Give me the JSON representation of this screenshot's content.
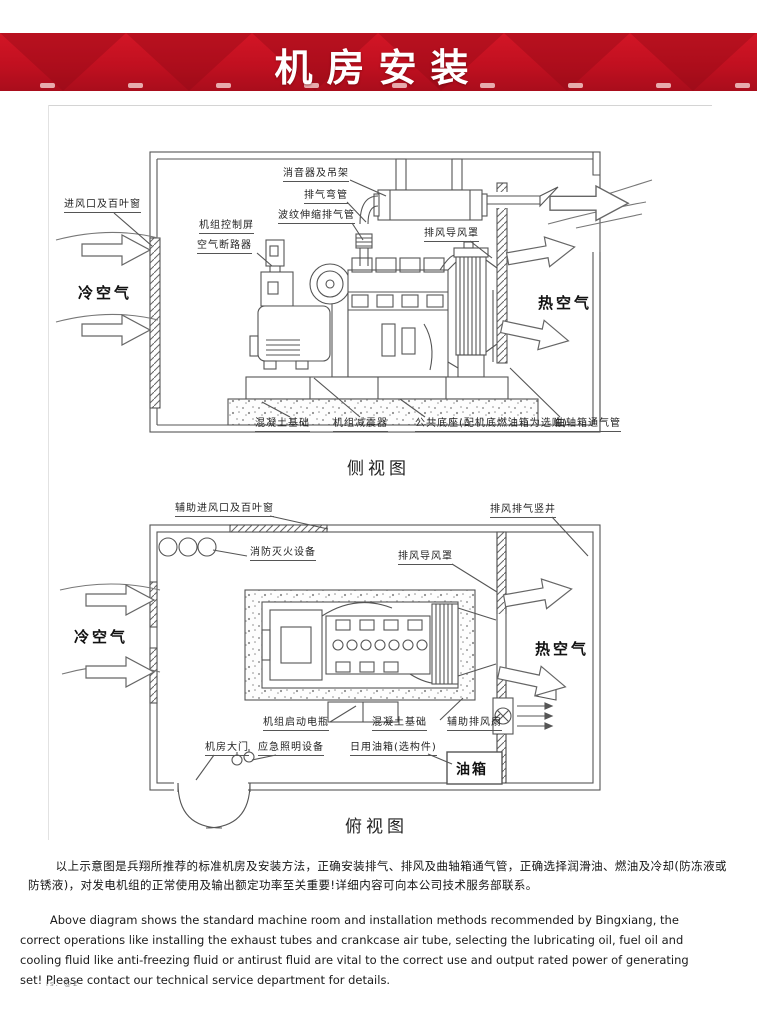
{
  "banner": {
    "title": "机房安装",
    "red": "#c11020",
    "red_dark": "#9c0c18"
  },
  "side_view": {
    "caption": "侧视图",
    "labels": {
      "muffler": "消音器及吊架",
      "elbow": "排气弯管",
      "bellows": "波纹伸缩排气管",
      "control_panel": "机组控制屏",
      "breaker": "空气断路器",
      "outlet_hood": "排风导风罩",
      "inlet_louver": "进风口及百叶窗",
      "cold_air": "冷空气",
      "hot_air": "热空气",
      "concrete": "混凝土基础",
      "damper": "机组减震器",
      "base": "公共底座(配机底燃油箱为选购)",
      "crankcase_pipe": "曲轴箱通气管"
    }
  },
  "top_view": {
    "caption": "俯视图",
    "labels": {
      "aux_inlet": "辅助进风口及百叶窗",
      "shaft": "排风排气竖井",
      "fire": "消防灭火设备",
      "outlet_hood": "排风导风罩",
      "cold_air": "冷空气",
      "hot_air": "热空气",
      "battery": "机组启动电瓶",
      "concrete": "混凝土基础",
      "aux_fan": "辅助排风扇",
      "door": "机房大门",
      "emergency_light": "应急照明设备",
      "day_tank": "日用油箱(选构件)",
      "tank": "油箱"
    }
  },
  "paragraphs": {
    "zh": "以上示意图是兵翔所推荐的标准机房及安装方法，正确安装排气、排风及曲轴箱通气管，正确选择润滑油、燃油及冷却(防冻液或防锈液)，对发电机组的正常使用及输出额定功率至关重要!详细内容可向本公司技术服务部联系。",
    "en": "Above diagram shows the standard machine room and installation methods recommended by Bingxiang, the correct operations like installing the exhaust tubes and crankcase air tube, selecting the lubricating oil, fuel oil and cooling fluid like anti-freezing fluid or antirust fluid are vital to the correct use and output rated power of generating set! Please contact our technical service department for details."
  },
  "footer_glyphs": "is. @2"
}
